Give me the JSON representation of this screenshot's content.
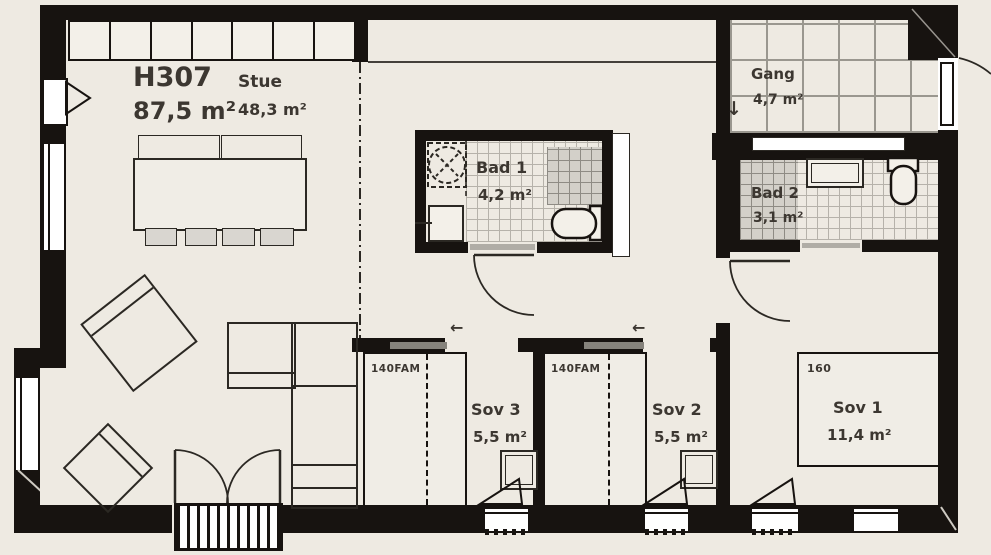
{
  "unit": {
    "id": "H307",
    "area": "87,5 m²"
  },
  "rooms": {
    "stue": {
      "name": "Stue",
      "area": "48,3 m²"
    },
    "bad1": {
      "name": "Bad 1",
      "area": "4,2 m²"
    },
    "gang": {
      "name": "Gang",
      "area": "4,7 m²"
    },
    "bad2": {
      "name": "Bad 2",
      "area": "3,1 m²"
    },
    "sov3": {
      "name": "Sov 3",
      "area": "5,5 m²"
    },
    "sov2": {
      "name": "Sov 2",
      "area": "5,5 m²"
    },
    "sov1": {
      "name": "Sov 1",
      "area": "11,4 m²"
    }
  },
  "furniture": {
    "bed_sov3_label": "140FAM",
    "bed_sov2_label": "140FAM",
    "bed_sov1_label": "160"
  },
  "symbols": {
    "gang_stair_arrow": "↓",
    "sov3_sliding_door_arrow": "←",
    "sov2_sliding_door_arrow": "←"
  },
  "colors": {
    "background": "#eeeae2",
    "wall": "#171310",
    "text": "#3c3731"
  }
}
